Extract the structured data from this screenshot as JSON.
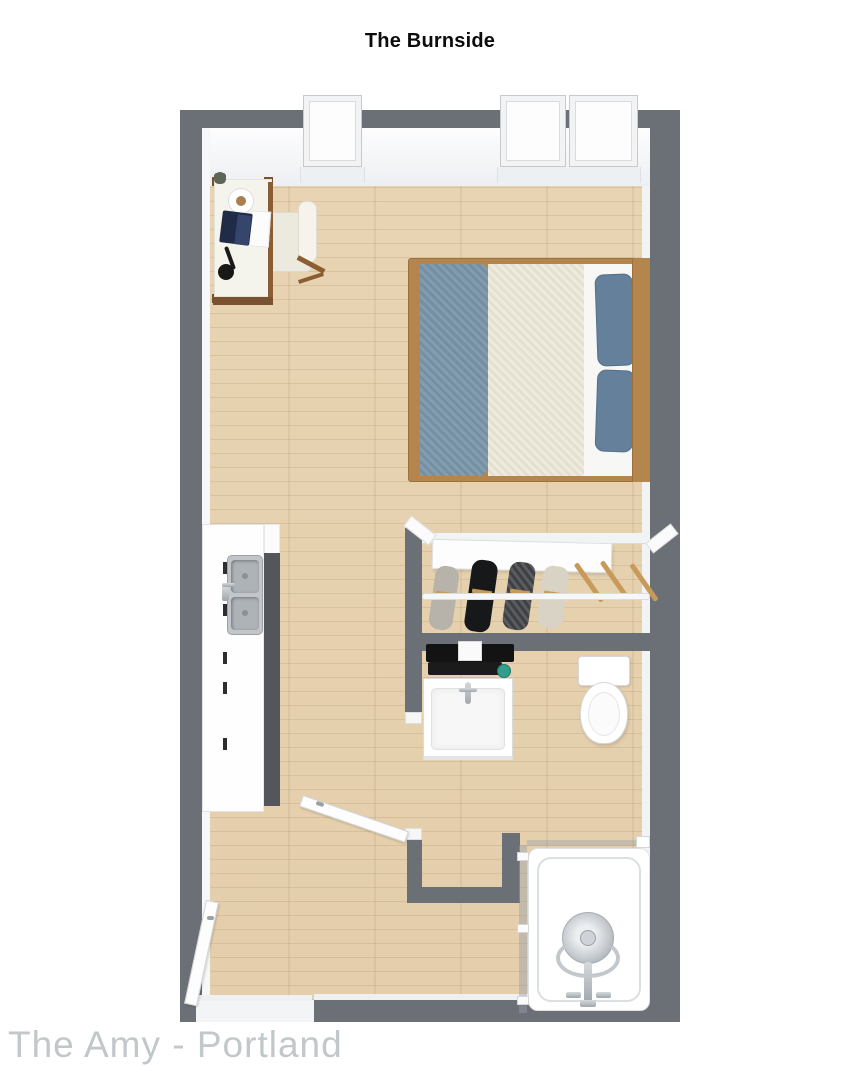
{
  "title": "The Burnside",
  "watermark": "The Amy - Portland",
  "palette": {
    "wall_gray": "#6b7077",
    "floor_wood": "#e8d4b3",
    "floor_grain": "#c9ab7e",
    "bed_frame_wood": "#b5854e",
    "bed_blanket_blue": "#7b97ab",
    "bed_duvet_cream": "#e9e4d3",
    "bed_sheet_white": "#f7f7f5",
    "bed_pillow_blue": "#64809a",
    "desk_wood": "#7a5230",
    "laptop_navy": "#1f2b47",
    "counter_side_gray": "#53575c",
    "sink_steel": "#b7bcc2",
    "shelf_black": "#141414",
    "soap_teal": "#2f9e8e",
    "glass_silver": "#aab3bb",
    "door_white": "#fdfdfd"
  },
  "furniture": [
    "window",
    "double-window",
    "desk",
    "desk-chair",
    "laptop",
    "papers",
    "coffee-cup",
    "desk-lamp",
    "plant",
    "double-bed",
    "pillow",
    "blanket",
    "kitchen-counter",
    "kitchen-sink",
    "cabinet-handle",
    "sliding-closet-door",
    "closet-rod",
    "hanging-garment",
    "wooden-hanger",
    "towel-shelf",
    "bathroom-vanity",
    "vanity-faucet",
    "soap-jar",
    "toilet",
    "shower-base",
    "shower-glass",
    "shower-head",
    "shower-faucet",
    "bathroom-door",
    "entry-door"
  ]
}
